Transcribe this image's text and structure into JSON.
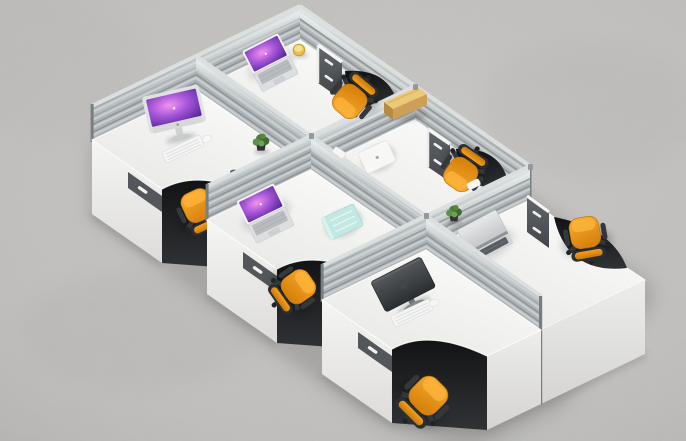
{
  "scene": {
    "subject": "Six-person modular office workstation pod, aerial view",
    "description": "Bird's-eye studio photograph of a six-person modular office workstation cluster standing on a light gray polished concrete floor. Two facing rows of three white L-shaped desks are divided by low silver slatted partition screens with frosted glass top bands. Each desk has a gray-fronted drawer pedestal and an orange task chair; desks hold laptops with purple wallpapers, an iMac, a dark monitor, keyboards, notebooks, a yellow document box, a yellow mug and small potted plants.",
    "view": "top-down three-quarter aerial product shot",
    "floor": "light gray polished concrete",
    "workstation_count": 6,
    "chair_count": 6,
    "lighting": "soft studio light from upper right"
  },
  "palette": {
    "floor": "#c3c2c0",
    "desk_top": "#f6f6f4",
    "desk_front": "#ececea",
    "partition_slats": "#aeb3b6",
    "partition_rim": "#dcdfe0",
    "partition_glass": "#e4ecea",
    "drawer_front": "#53575b",
    "pedestal_handle": "#f2f2f0",
    "chair_seat_orange": "#f09a1c",
    "chair_frame": "#2d3033",
    "screen_glow_purple": "#a857da",
    "notebook_teal": "#c2e8e3",
    "box_yellow": "#ecc878",
    "plant_green": "#4d7c3a",
    "shadow": "#8e8d8b"
  },
  "workstations": [
    {
      "id": "outer-top",
      "desk": "white L-top, mobile cabinet with two handles",
      "items": [
        "open MacBook with purple wallpaper",
        "yellow mug"
      ],
      "chair": "orange task chair, tucked in, facing the desk"
    },
    {
      "id": "outer-middle",
      "desk": "white L-top, mobile cabinet with two handles",
      "items": [
        "closed white notebook",
        "yellow document box on the screen rail"
      ],
      "chair": "orange task chair, tucked in"
    },
    {
      "id": "outer-bottom",
      "desk": "white L-top, gray pedestal",
      "items": [
        "open silver laptop",
        "small potted plant",
        "small white box on desk"
      ],
      "chair": "orange task chair, pulled out to the open side"
    },
    {
      "id": "inner-top",
      "desk": "white L-top, drawer pedestal with handle slot",
      "items": [
        "iMac with purple wallpaper",
        "white keyboard",
        "white mouse",
        "small potted plant"
      ],
      "chair": "orange task chair, tucked under the desk"
    },
    {
      "id": "inner-middle",
      "desk": "white L-top, drawer pedestal with handle slot",
      "items": [
        "open MacBook with purple wallpaper",
        "teal notebook"
      ],
      "chair": "orange task chair, half tucked"
    },
    {
      "id": "inner-bottom",
      "desk": "white L-top, drawer pedestal with handle slot",
      "items": [
        "dark monitor seen from behind",
        "white keyboard",
        "white mouse"
      ],
      "chair": "orange task chair, pulled out onto the floor"
    }
  ],
  "partitions": {
    "style": "silver aluminium frame, slatted lower band, frosted glass upper band, white cap accessories on rails",
    "count_long": 2,
    "count_cross": 3
  }
}
